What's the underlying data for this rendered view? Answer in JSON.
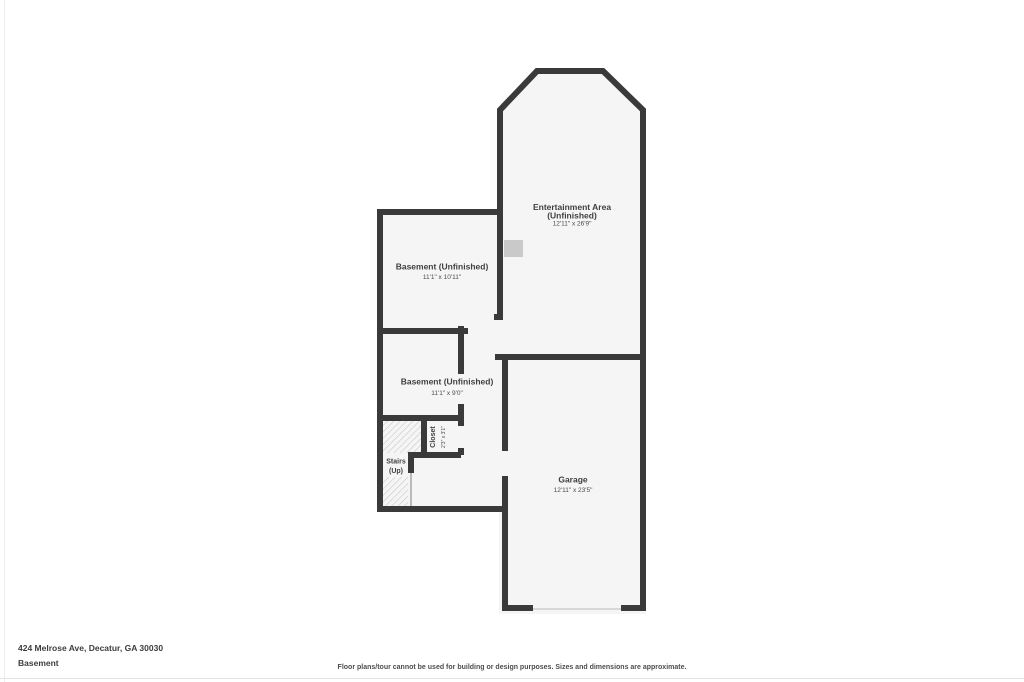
{
  "page": {
    "address": "424 Melrose Ave, Decatur, GA 30030",
    "floor_label": "Basement",
    "disclaimer": "Floor plans/tour cannot be used for building or design purposes. Sizes and dimensions are approximate."
  },
  "colors": {
    "wall": "#3a3a3a",
    "room_fill": "#f5f5f5",
    "hatch_line": "#c6c6c6",
    "text": "#3f3f3f",
    "feature_gray": "#c9c9c9",
    "garage_door_line": "#d8d8d8"
  },
  "rooms": {
    "entertainment": {
      "name": "Entertainment Area",
      "sub": "(Unfinished)",
      "dims": "12'11\" x 26'9\""
    },
    "basement1": {
      "name": "Basement (Unfinished)",
      "dims": "11'1\" x 10'11\""
    },
    "basement2": {
      "name": "Basement (Unfinished)",
      "dims": "11'1\" x 9'0\""
    },
    "closet": {
      "name": "Closet",
      "dims": "2'3\" x 3'1\""
    },
    "stairs": {
      "name": "Stairs",
      "sub": "(Up)"
    },
    "garage": {
      "name": "Garage",
      "dims": "12'11\" x 23'5\""
    }
  }
}
